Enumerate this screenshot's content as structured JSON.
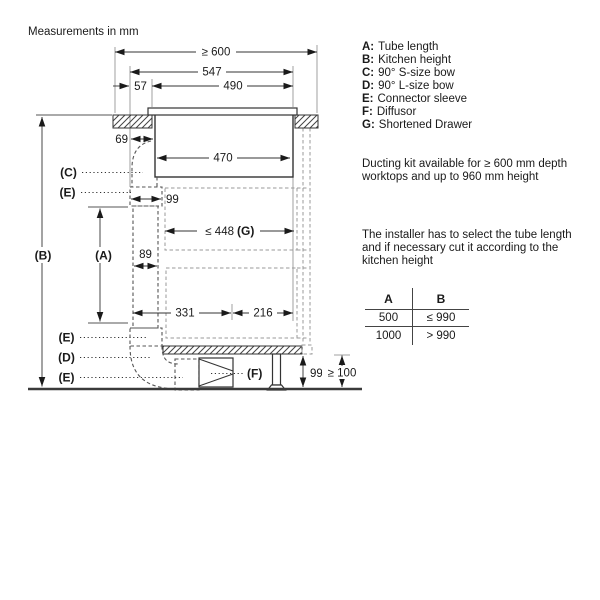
{
  "header": {
    "note": "Measurements in mm"
  },
  "legend": {
    "items": [
      {
        "key": "A:",
        "label": "Tube length"
      },
      {
        "key": "B:",
        "label": "Kitchen height"
      },
      {
        "key": "C:",
        "label": "90° S-size bow"
      },
      {
        "key": "D:",
        "label": "90° L-size bow"
      },
      {
        "key": "E:",
        "label": "Connector sleeve"
      },
      {
        "key": "F:",
        "label": "Diffusor"
      },
      {
        "key": "G:",
        "label": "Shortened Drawer"
      }
    ]
  },
  "notes": {
    "availability": "Ducting kit available for ≥ 600 mm depth worktops and up to 960 mm height",
    "installer": "The installer has to select the tube length and if necessary cut it according to the kitchen height"
  },
  "size_table": {
    "headers": {
      "a": "A",
      "b": "B"
    },
    "rows": [
      {
        "a": "500",
        "b": "≤ 990"
      },
      {
        "a": "1000",
        "b": "> 990"
      }
    ]
  },
  "dims": {
    "depth_min": "≥ 600",
    "cutout_547": "547",
    "offset_57": "57",
    "cutout_490": "490",
    "offset_69": "69",
    "hob_width_470": "470",
    "sleeve_99": "99",
    "drawer_448": "≤ 448",
    "drawer_g": "(G)",
    "tube_89": "89",
    "span_331": "331",
    "span_216": "216",
    "plinth_99": "99",
    "plinth_min_100": "≥ 100"
  },
  "parts": {
    "a": "(A)",
    "b": "(B)",
    "c": "(C)",
    "d": "(D)",
    "e1": "(E)",
    "e2": "(E)",
    "e3": "(E)",
    "f": "(F)"
  }
}
